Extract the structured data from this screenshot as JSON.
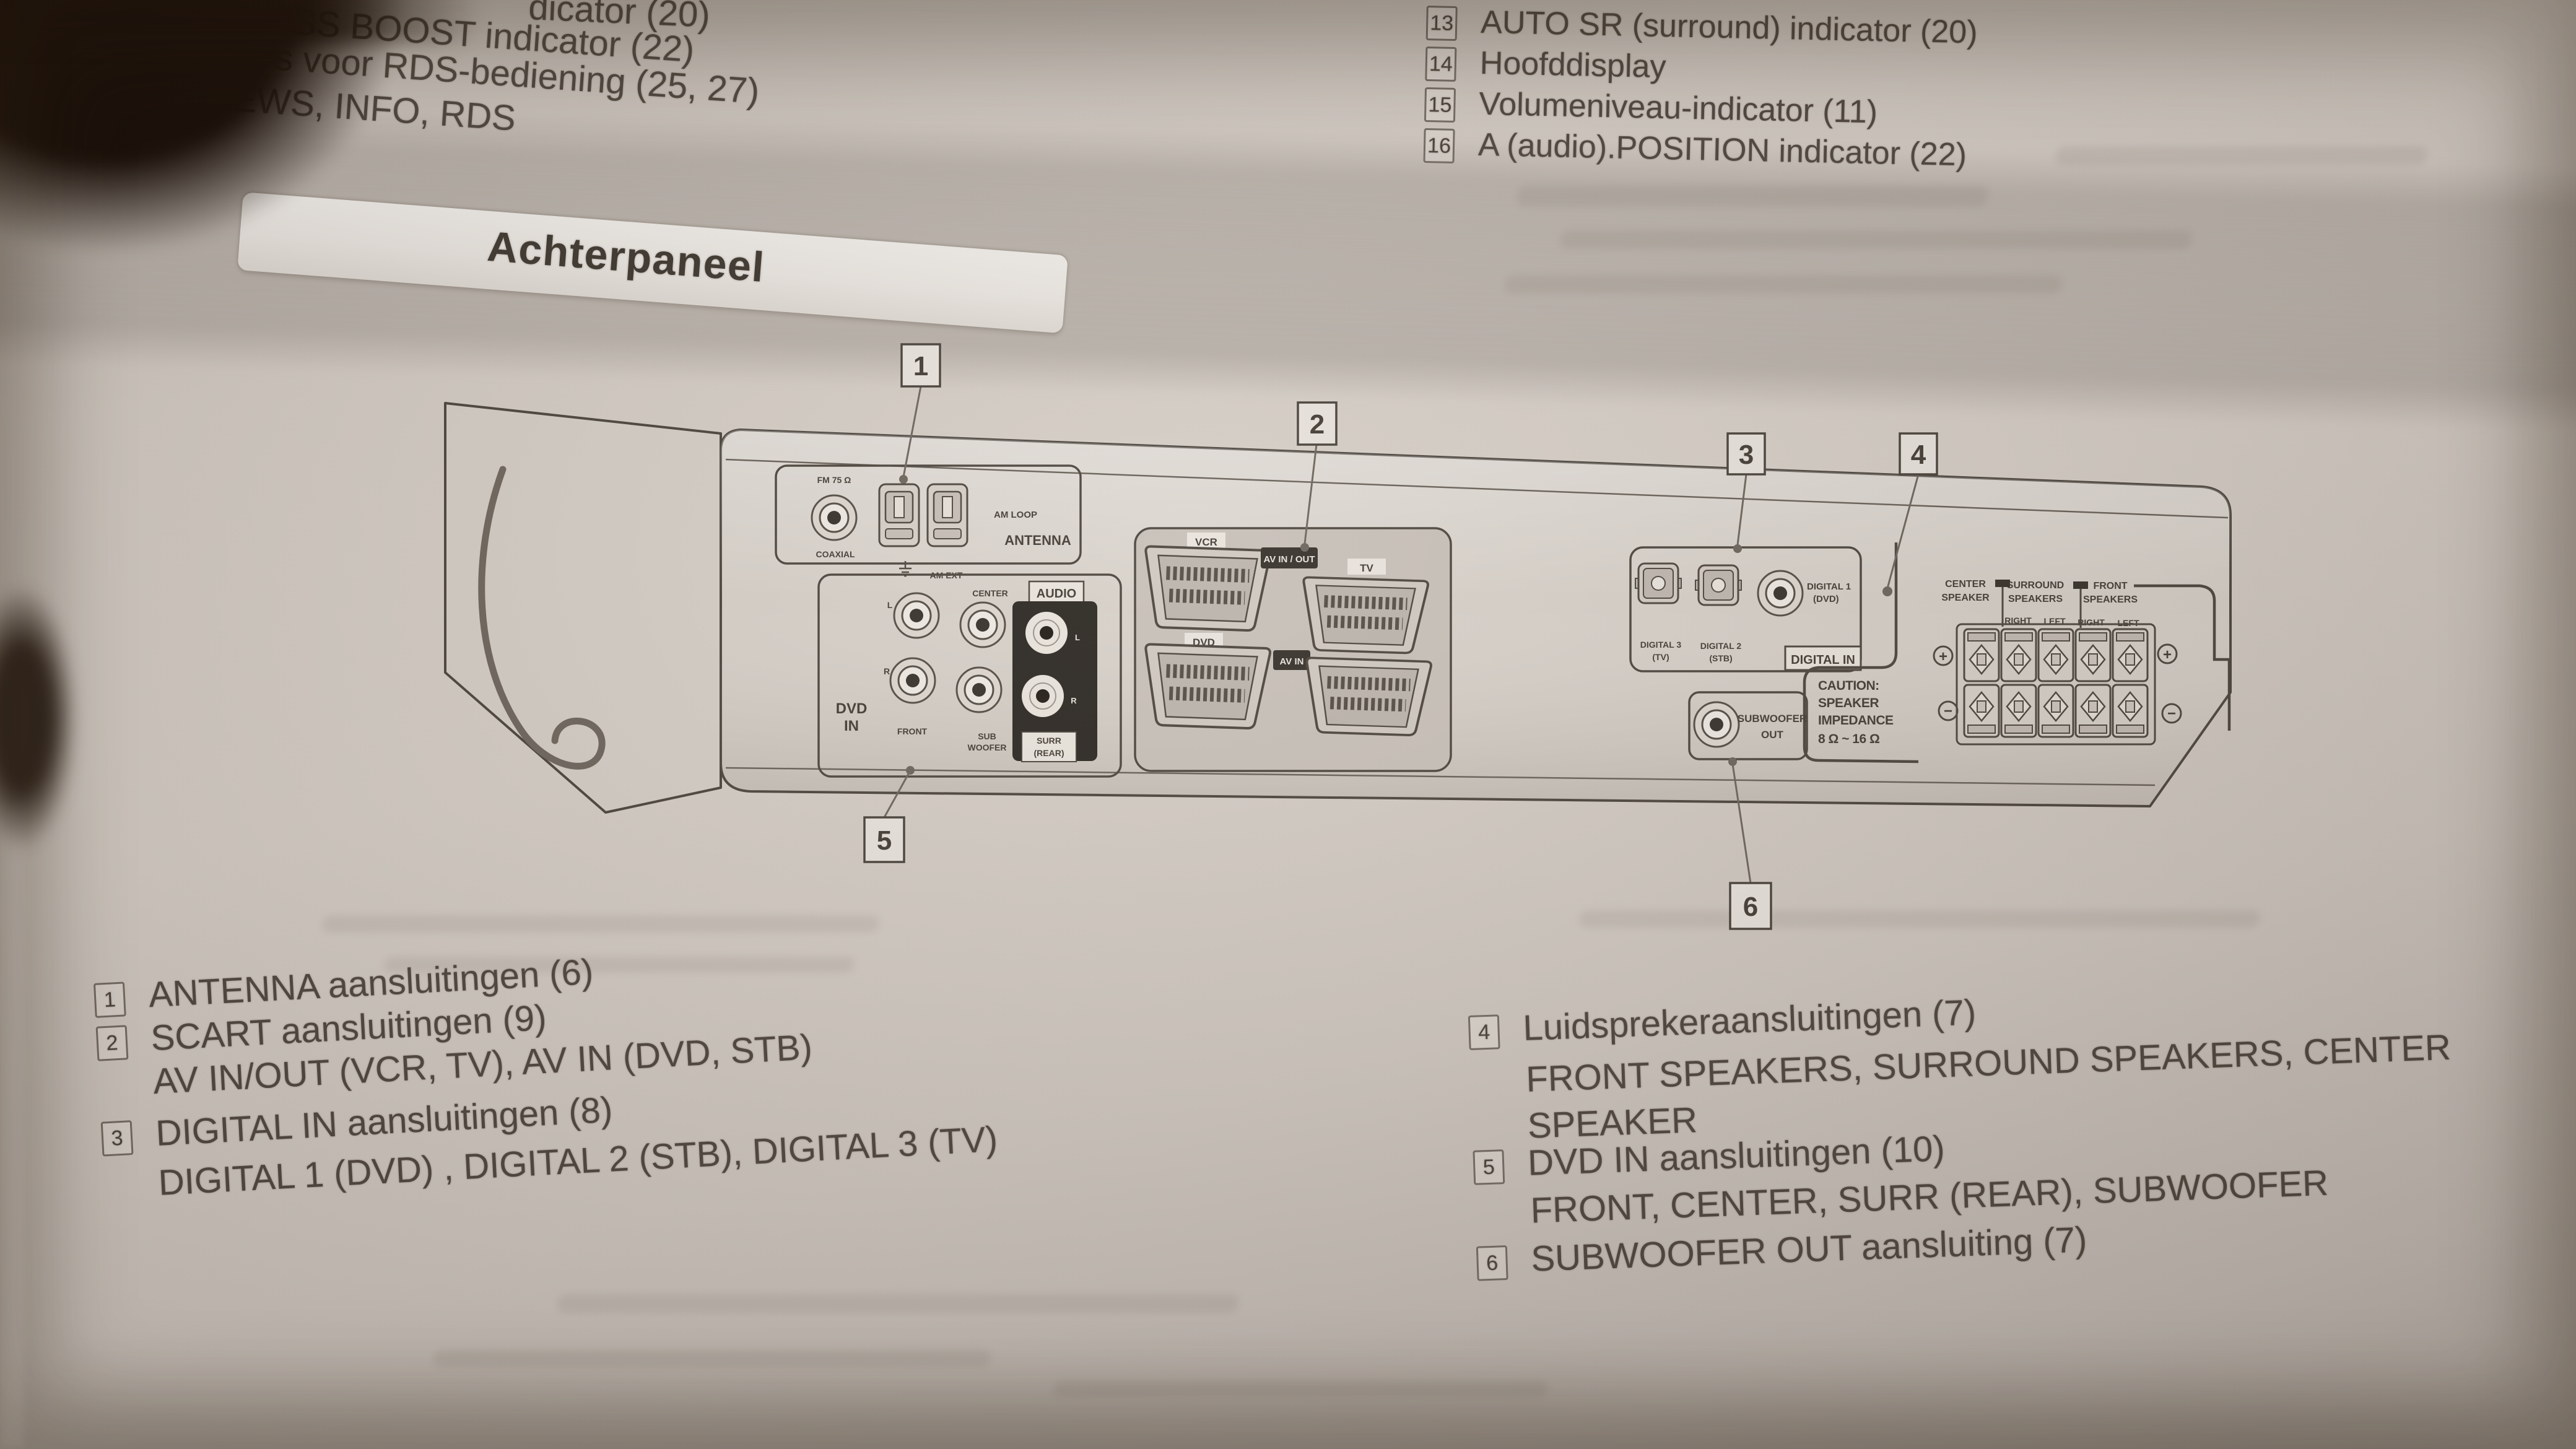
{
  "page": {
    "header_banner": "Achterpaneel",
    "top_left_lines": [
      "dicator (20)",
      "SS BOOST indicator (22)",
      "Indicators voor RDS-bediening (25, 27)",
      "TA, NEWS, INFO, RDS"
    ],
    "top_right_items": [
      {
        "num": "13",
        "text": "AUTO SR (surround) indicator (20)"
      },
      {
        "num": "14",
        "text": "Hoofddisplay"
      },
      {
        "num": "15",
        "text": "Volumeniveau-indicator (11)"
      },
      {
        "num": "16",
        "text": "A (audio).POSITION indicator (22)"
      }
    ]
  },
  "diagram": {
    "callouts": [
      "1",
      "2",
      "3",
      "4",
      "5",
      "6"
    ],
    "antenna": {
      "fm": "FM 75 Ω",
      "coaxial": "COAXIAL",
      "am_loop": "AM LOOP",
      "antenna": "ANTENNA",
      "am_ext": "AM EXT"
    },
    "dvd": {
      "audio": "AUDIO",
      "l": "L",
      "r": "R",
      "l2": "L",
      "r2": "R",
      "front": "FRONT",
      "center": "CENTER",
      "sub": [
        "SUB",
        "WOOFER"
      ],
      "surr": [
        "SURR",
        "(REAR)"
      ],
      "dvd_in": [
        "DVD",
        "IN"
      ]
    },
    "scart": {
      "vcr": "VCR",
      "tv": "TV",
      "dvd": "DVD",
      "stb": "STB",
      "av_in_out": "AV IN / OUT",
      "av_in": "AV IN"
    },
    "digital": {
      "d3": [
        "DIGITAL 3",
        "(TV)"
      ],
      "d2": [
        "DIGITAL 2",
        "(STB)"
      ],
      "d1": [
        "DIGITAL 1",
        "(DVD)"
      ],
      "digital_in": "DIGITAL IN"
    },
    "subwoofer_out": [
      "SUBWOOFER",
      "OUT"
    ],
    "caution": [
      "CAUTION:",
      "SPEAKER",
      "IMPEDANCE",
      "8 Ω ~ 16 Ω"
    ],
    "speakers": {
      "center": [
        "CENTER",
        "SPEAKER"
      ],
      "surround": [
        "SURROUND",
        "SPEAKERS"
      ],
      "front": [
        "FRONT",
        "SPEAKERS"
      ],
      "pos": [
        "RIGHT",
        "LEFT",
        "RIGHT",
        "LEFT"
      ],
      "plus": "+",
      "minus": "−"
    }
  },
  "legend": {
    "left": [
      {
        "num": "1",
        "title": "ANTENNA aansluitingen (6)"
      },
      {
        "num": "2",
        "title": "SCART aansluitingen (9)",
        "sub": "AV IN/OUT (VCR, TV), AV IN (DVD, STB)"
      },
      {
        "num": "3",
        "title": "DIGITAL IN aansluitingen (8)",
        "sub": "DIGITAL 1 (DVD) , DIGITAL 2 (STB), DIGITAL 3 (TV)"
      }
    ],
    "right": [
      {
        "num": "4",
        "title": "Luidsprekeraansluitingen (7)",
        "sub": "FRONT SPEAKERS, SURROUND SPEAKERS, CENTER",
        "sub2": "SPEAKER"
      },
      {
        "num": "5",
        "title": "DVD IN aansluitingen (10)",
        "sub": "FRONT, CENTER, SURR (REAR), SUBWOOFER"
      },
      {
        "num": "6",
        "title": "SUBWOOFER OUT aansluiting (7)"
      }
    ]
  }
}
